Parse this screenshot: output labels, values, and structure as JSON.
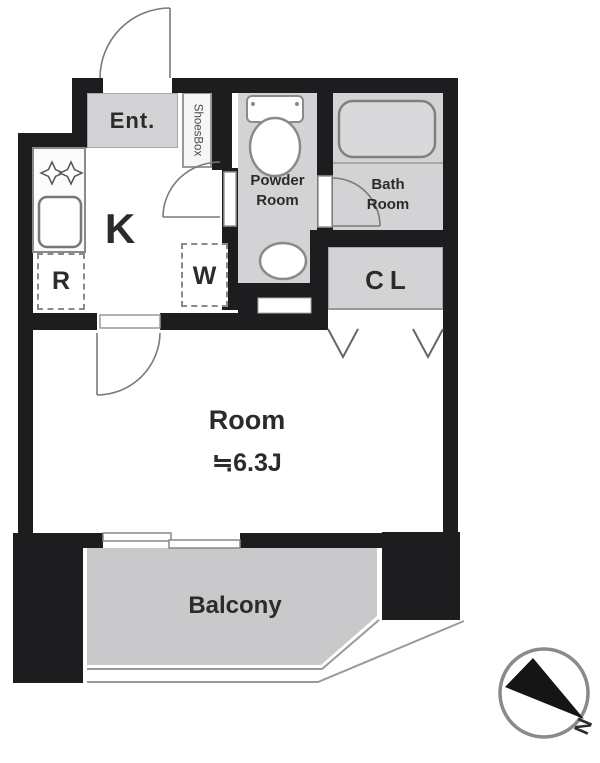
{
  "floorplan": {
    "labels": {
      "entrance": "Ent.",
      "shoes_box": "ShoesBox",
      "kitchen": "K",
      "refrigerator": "R",
      "washer": "W",
      "powder_room": "Powder\nRoom",
      "bath_room": "Bath\nRoom",
      "closet": "CL",
      "room": "Room",
      "room_size": "≒6.3J",
      "balcony": "Balcony",
      "north": "N"
    },
    "colors": {
      "wall": "#1d1d1f",
      "room_fill": "#d3d3d5",
      "balcony_fill": "#c9c9cb",
      "fixture_stroke": "#8a8a8a",
      "door_stroke": "#7a7a7a",
      "text": "#2b2b2b"
    }
  }
}
